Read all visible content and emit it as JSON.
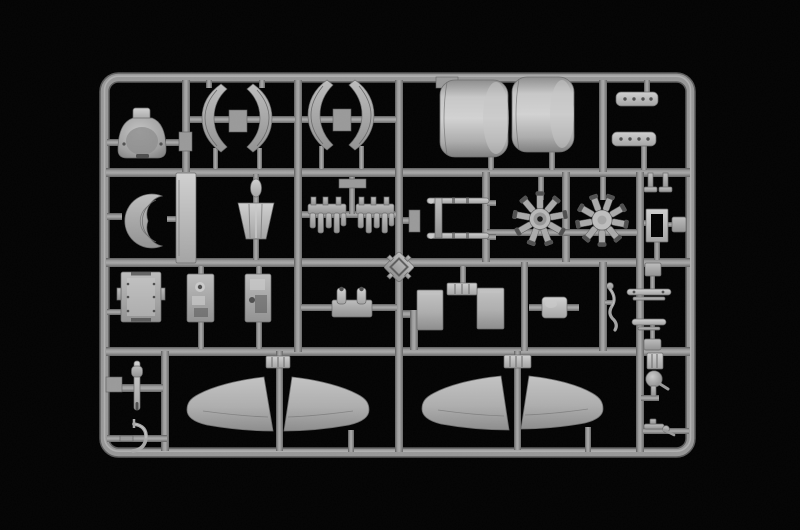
{
  "scene": {
    "subject": "model-kit-sprue-photo",
    "description": "light gray plastic sprue of aircraft model parts on black background"
  },
  "colors": {
    "background": "#030303",
    "runner": "#8e8e8e",
    "runner-edge": "#5d5d5d",
    "plastic-light": "#c9c9c9",
    "plastic-mid": "#a6a6a6",
    "plastic-dark": "#6a6a6a",
    "plastic-shadow": "#4f4f4f",
    "hole": "#1a1a1a"
  },
  "sprue": {
    "frame": {
      "name": "sprue-frame",
      "shape": "rounded-rectangle"
    },
    "parts": [
      {
        "name": "cowl-front",
        "label": "cowl front piece with intake cap"
      },
      {
        "name": "fairing-half-1",
        "label": "curved fairing half"
      },
      {
        "name": "fairing-half-2",
        "label": "curved fairing half"
      },
      {
        "name": "fairing-half-3",
        "label": "curved fairing half"
      },
      {
        "name": "fairing-half-4",
        "label": "curved fairing half"
      },
      {
        "name": "engine-cowling-1",
        "label": "large engine cowling barrel"
      },
      {
        "name": "engine-cowling-2",
        "label": "large engine cowling barrel"
      },
      {
        "name": "exhaust-stack-1",
        "label": "exhaust stack bar"
      },
      {
        "name": "exhaust-stack-2",
        "label": "exhaust stack bar"
      },
      {
        "name": "cowl-ring",
        "label": "crescent cowl ring"
      },
      {
        "name": "spar-strip",
        "label": "flat spar strip"
      },
      {
        "name": "fuel-tank",
        "label": "tapered tank with spindle"
      },
      {
        "name": "cylinder-bank-1",
        "label": "engine cylinder bank comb"
      },
      {
        "name": "cylinder-bank-2",
        "label": "engine cylinder bank comb"
      },
      {
        "name": "landing-gear-struts",
        "label": "pair of landing gear legs"
      },
      {
        "name": "radial-engine-1",
        "label": "nine-cylinder radial engine"
      },
      {
        "name": "radial-engine-2",
        "label": "nine-cylinder radial engine"
      },
      {
        "name": "mount-frame",
        "label": "open rectangular mount frame"
      },
      {
        "name": "mount-pin-1",
        "label": "inverted T mount pin"
      },
      {
        "name": "mount-pin-2",
        "label": "inverted T mount pin"
      },
      {
        "name": "junction-block-1",
        "label": "small block part"
      },
      {
        "name": "junction-block-2",
        "label": "small block part"
      },
      {
        "name": "cockpit-floor",
        "label": "riveted floor hatch panel"
      },
      {
        "name": "cockpit-sidewall-1",
        "label": "detailed sidewall panel"
      },
      {
        "name": "cockpit-sidewall-2",
        "label": "detailed sidewall panel"
      },
      {
        "name": "gun-breech",
        "label": "twin-cylinder gun breech"
      },
      {
        "name": "gunsight-frame",
        "label": "diamond gunsight frame"
      },
      {
        "name": "hatch-door-1",
        "label": "square hatch door"
      },
      {
        "name": "hatch-door-2",
        "label": "square hatch door"
      },
      {
        "name": "door-hinge-bracket",
        "label": "ribbed hinge bracket"
      },
      {
        "name": "equipment-box",
        "label": "rounded equipment box"
      },
      {
        "name": "control-lever",
        "label": "curved control lever"
      },
      {
        "name": "stabilizer-bar-1",
        "label": "cross bar with stem"
      },
      {
        "name": "stabilizer-bar-2",
        "label": "cross bar with stem"
      },
      {
        "name": "tail-strut",
        "label": "tail strut pin"
      },
      {
        "name": "tail-skid-hook",
        "label": "curved tail skid hook"
      },
      {
        "name": "wing-panel-port-1",
        "label": "port wing panel, lower pair"
      },
      {
        "name": "wing-panel-starboard-1",
        "label": "starboard wing panel, lower pair"
      },
      {
        "name": "wing-panel-port-2",
        "label": "port wing panel, upper pair"
      },
      {
        "name": "wing-panel-starboard-2",
        "label": "starboard wing panel, upper pair"
      },
      {
        "name": "rib-connector-1",
        "label": "ribbed connector block"
      },
      {
        "name": "rib-connector-2",
        "label": "ribbed connector block"
      },
      {
        "name": "rib-connector-3",
        "label": "ribbed connector block"
      },
      {
        "name": "tail-wheel",
        "label": "ball tail wheel"
      },
      {
        "name": "machine-gun",
        "label": "small machine gun part"
      }
    ]
  }
}
